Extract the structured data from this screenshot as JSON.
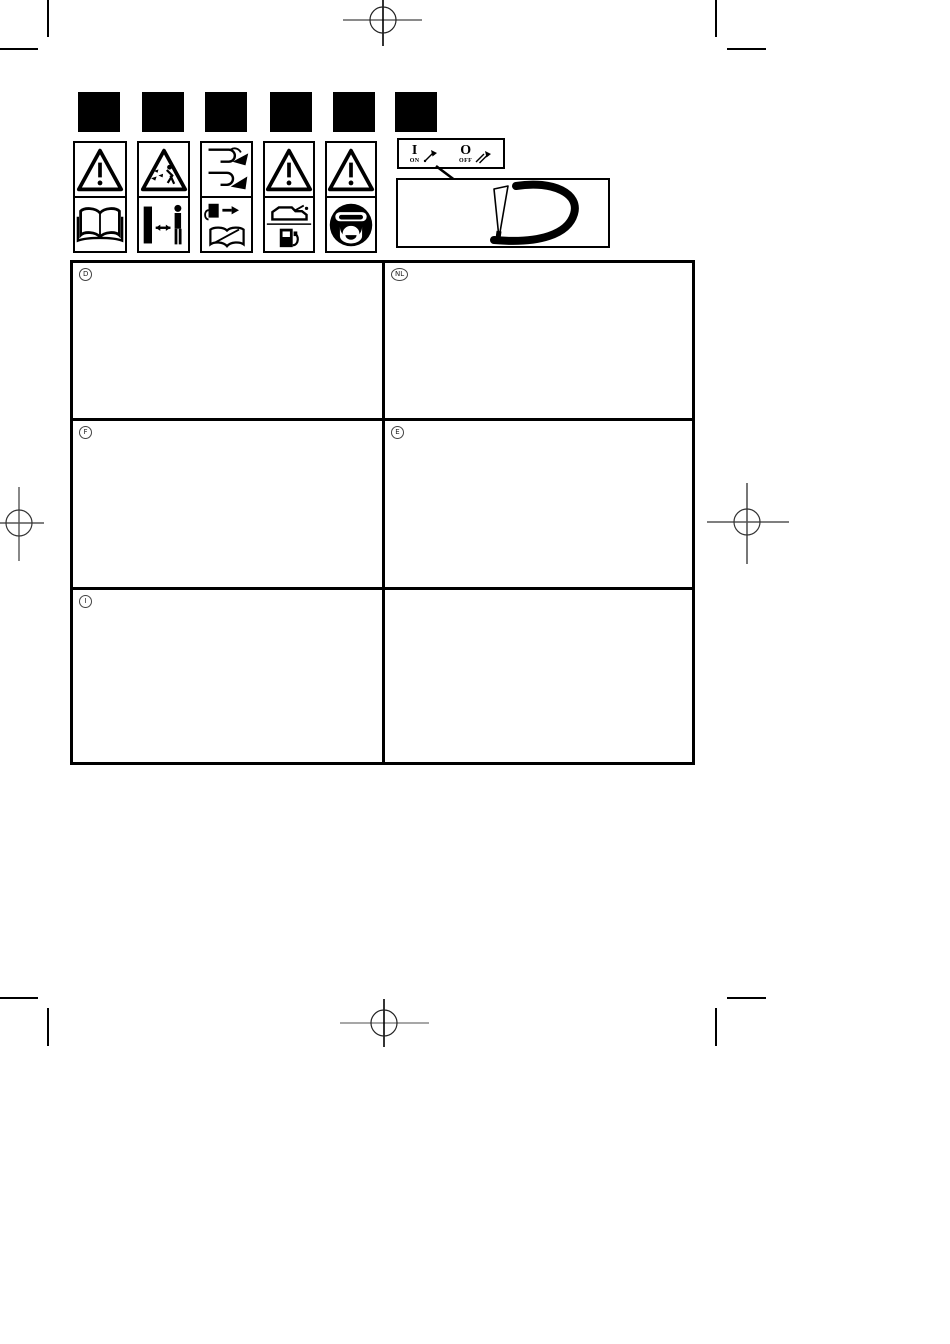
{
  "page": {
    "kind": "scanned instruction manual page",
    "background_color": "#ffffff",
    "ink_color": "#000000",
    "crosshair_gray": "#8a8a8a"
  },
  "symbol_squares": {
    "count": 6,
    "fill": "#000000"
  },
  "pictogram_columns": [
    {
      "top_icon": "warning-triangle-icon",
      "bottom_icon": "read-manual-book-icon"
    },
    {
      "top_icon": "thrown-objects-warning-icon",
      "bottom_icon": "keep-bystanders-away-icon"
    },
    {
      "top_icon": "hand-cut-hazard-icon",
      "bottom_icon": "disconnect-spark-plug-read-manual-icon"
    },
    {
      "top_icon": "warning-triangle-icon",
      "bottom_icon": "oil-and-fuel-icon"
    },
    {
      "top_icon": "warning-triangle-icon",
      "bottom_icon": "wear-face-protection-icon"
    }
  ],
  "switch_legend": {
    "on_symbol": "I",
    "on_label": "ON",
    "off_symbol": "O",
    "off_label": "OFF",
    "on_icon": "throttle-lever-on-icon",
    "off_icon": "throttle-lever-off-icon"
  },
  "handle_figure": {
    "icon": "loop-handle-with-throttle-lever"
  },
  "language_table": {
    "cells": [
      {
        "code": "D"
      },
      {
        "code": "NL"
      },
      {
        "code": "F"
      },
      {
        "code": "E"
      },
      {
        "code": "I"
      },
      {
        "code": ""
      }
    ]
  }
}
